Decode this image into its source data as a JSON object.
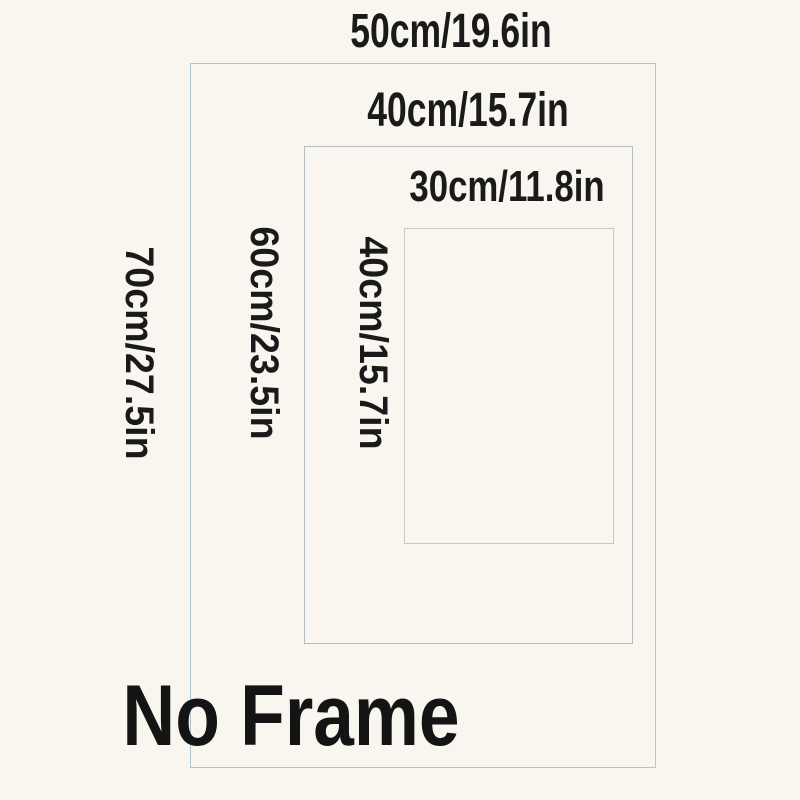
{
  "title": "Poster size diagram",
  "colors": {
    "background": "#f9f6f0",
    "text": "#1a1a1a",
    "outer_border": "#aec8da",
    "middle_border": "#b4bdc2",
    "inner_border": "#cbc8c2"
  },
  "sizes": {
    "outer": {
      "width_label": "50cm/19.6in",
      "height_label": "70cm/27.5in"
    },
    "middle": {
      "width_label": "40cm/15.7in",
      "height_label": "60cm/23.5in"
    },
    "inner": {
      "width_label": "30cm/11.8in",
      "height_label": "40cm/15.7in"
    }
  },
  "footer": {
    "frame_note": "No Frame"
  }
}
